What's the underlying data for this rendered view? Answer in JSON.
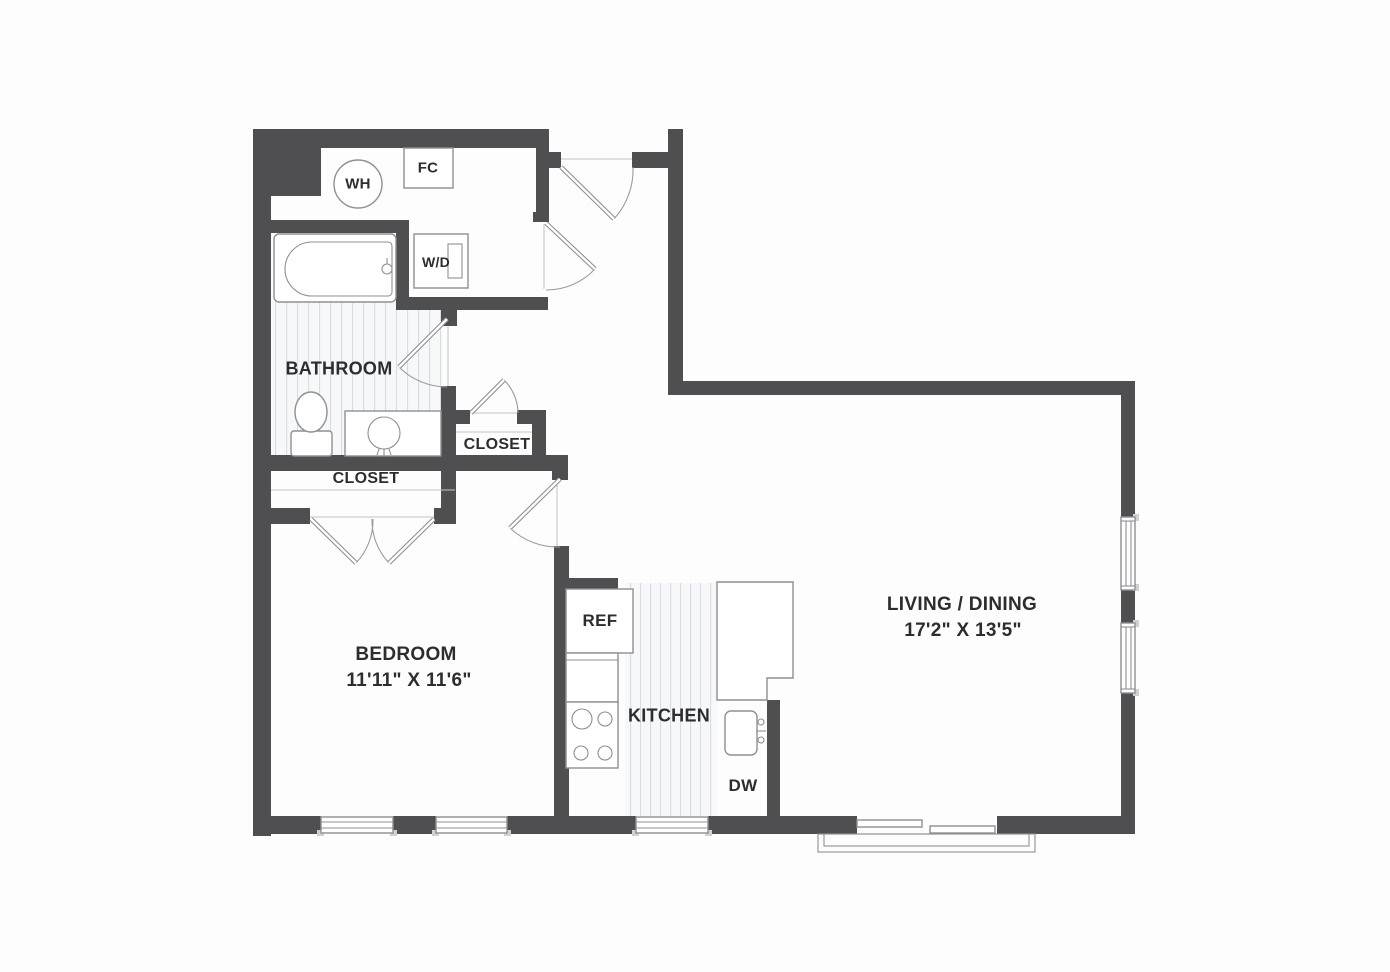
{
  "title": "One-bedroom apartment floor plan",
  "rooms": {
    "bathroom": {
      "label": "BATHROOM"
    },
    "hall_closet": {
      "label": "CLOSET"
    },
    "bedroom_closet": {
      "label": "CLOSET"
    },
    "bedroom": {
      "label": "BEDROOM",
      "dimensions": "11'11\" X 11'6\""
    },
    "kitchen": {
      "label": "KITCHEN"
    },
    "living_dining": {
      "label": "LIVING / DINING",
      "dimensions": "17'2\" X 13'5\""
    }
  },
  "fixtures": {
    "water_heater": {
      "label": "WH"
    },
    "fan_coil": {
      "label": "FC"
    },
    "washer_dryer": {
      "label": "W/D"
    },
    "refrigerator": {
      "label": "REF"
    },
    "dishwasher": {
      "label": "DW"
    }
  },
  "colors": {
    "wall": "#4f4f52",
    "fixture_line": "#8f9093",
    "stripe": "#d9dce1",
    "text": "#2d2d2f",
    "background": "#fdfdfd"
  }
}
